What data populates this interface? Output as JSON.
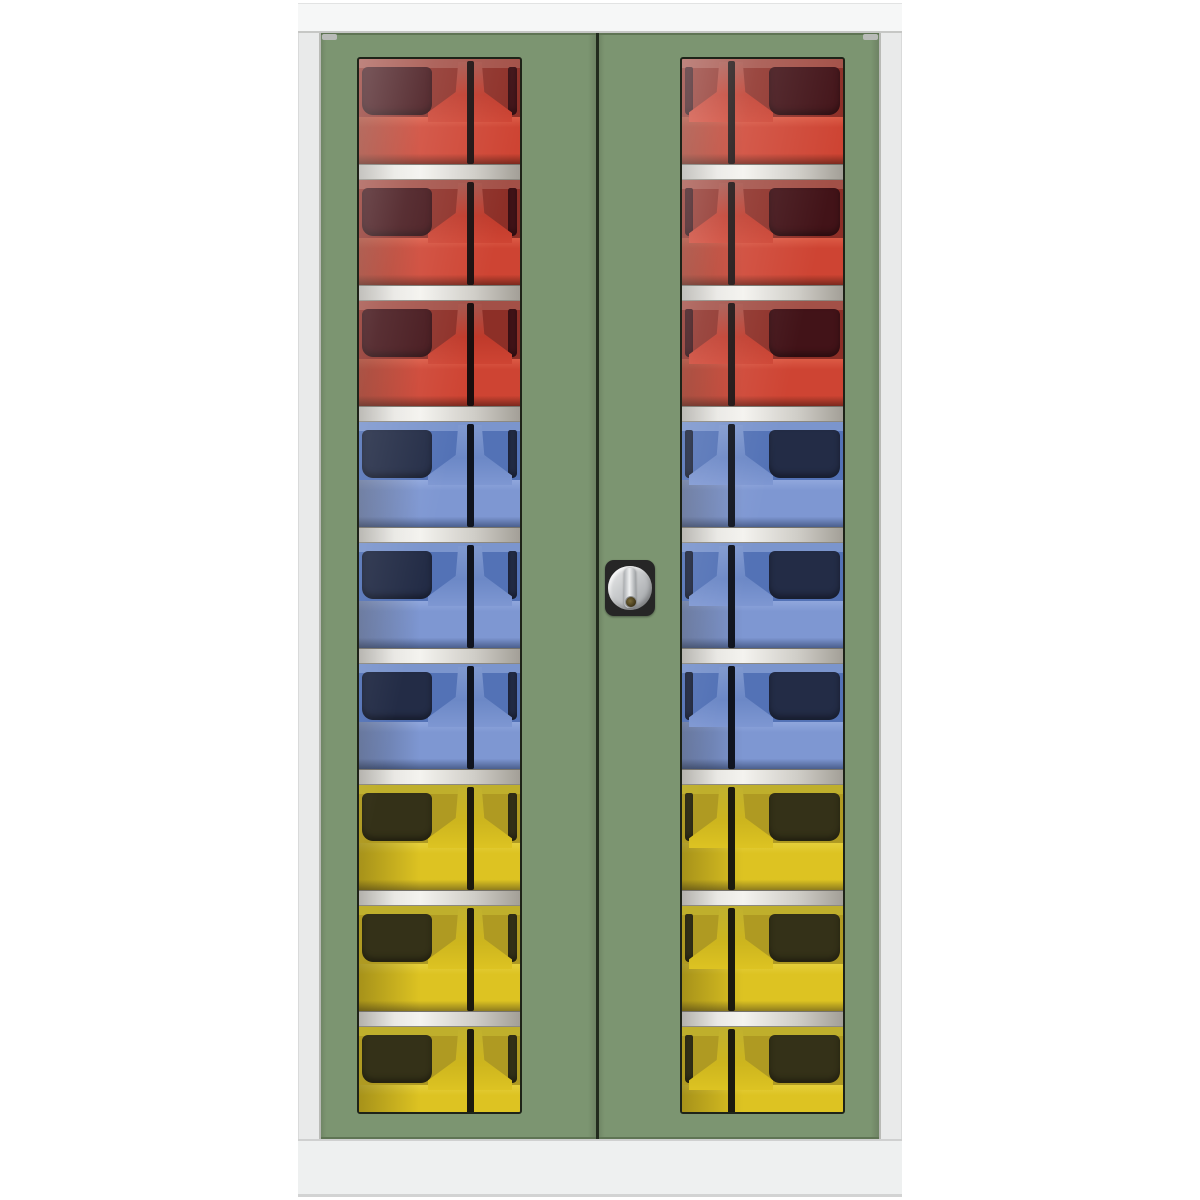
{
  "scene": {
    "description": "Product photo of a tall steel storage cupboard with two green vision-panel doors; coloured open-fronted storage bins (red, blue, yellow) are visible on shelves through the acrylic windows",
    "background_color": "#ffffff"
  },
  "theme": {
    "bg": "#ffffff",
    "frame_top": "#f6f7f7",
    "frame_side": "#e9eaea",
    "frame_edge": "#c6c7c5",
    "plinth": "#eef0f0",
    "plinth_edge": "#cfd0d0",
    "door_green": "#7c9571",
    "door_gap": "#222b1e",
    "window_frame": "#1e2318",
    "lock_body": "#262626",
    "lock_silver_hi": "#eceded",
    "lock_silver_lo": "#9b9ea1",
    "keyhole": "#7a6a3a"
  },
  "cabinet": {
    "doors": 2,
    "door_color": "#7c9571",
    "frame_color": "#f6f7f7",
    "windows_per_door": 1,
    "shelves_visible_per_window": 8,
    "bin_rows_visible_per_window": 9,
    "shelf_color_light": "#f4f3ef",
    "shelf_color_dark": "#a39f97",
    "lock": {
      "type": "cylinder turn-knob lock",
      "body_color": "#262626",
      "knob_color": "#c7c9cb",
      "keyhole_color": "#7a6a3a"
    }
  },
  "bins": {
    "row_colors": [
      "red",
      "red",
      "red",
      "blue",
      "blue",
      "blue",
      "yellow",
      "yellow",
      "yellow"
    ],
    "rows_red": 3,
    "rows_blue": 3,
    "rows_yellow": 3,
    "palette": {
      "red": {
        "rim": "#a5544b",
        "dark": "#421318",
        "mid": "#8d2f27",
        "bright": "#ce4433",
        "front_top": "#dc5a45",
        "front_bottom": "#7c291e",
        "post": "#bf3a2b",
        "slot": "#1a0d0d"
      },
      "blue": {
        "rim": "#8099cf",
        "dark": "#232c46",
        "mid": "#5372b6",
        "bright": "#7e97d2",
        "front_top": "#90a7dd",
        "front_bottom": "#4b5f8d",
        "post": "#6c88c6",
        "slot": "#10141f"
      },
      "yellow": {
        "rim": "#c1b12e",
        "dark": "#343118",
        "mid": "#af9a22",
        "bright": "#ddc322",
        "front_top": "#e5cf3a",
        "front_bottom": "#8f7d1e",
        "post": "#cdb51e",
        "slot": "#1c1a0e"
      }
    }
  }
}
